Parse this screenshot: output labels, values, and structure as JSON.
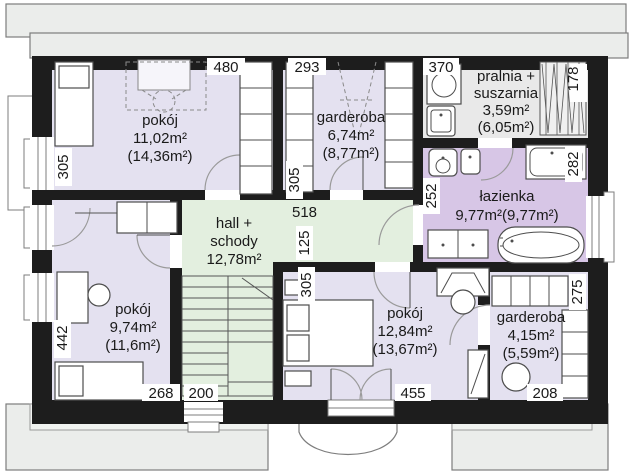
{
  "plan_title": "attic floor plan",
  "rooms": {
    "pokoj1": {
      "name": "pokój",
      "area": "11,02m²",
      "area_total": "(14,36m²)"
    },
    "garderoba1": {
      "name": "garderoba",
      "area": "6,74m²",
      "area_total": "(8,77m²)"
    },
    "pralnia": {
      "name_line1": "pralnia +",
      "name_line2": "suszarnia",
      "area": "3,59m²",
      "area_total": "(6,05m²)"
    },
    "lazienka": {
      "name": "łazienka",
      "area": "9,77m²(9,77m²)"
    },
    "hall": {
      "name_line1": "hall +",
      "name_line2": "schody",
      "area": "12,78m²"
    },
    "pokoj2": {
      "name": "pokój",
      "area": "9,74m²",
      "area_total": "(11,6m²)"
    },
    "pokoj3": {
      "name": "pokój",
      "area": "12,84m²",
      "area_total": "(13,67m²)"
    },
    "garderoba2": {
      "name": "garderoba",
      "area": "4,15m²",
      "area_total": "(5,59m²)"
    }
  },
  "dims": {
    "pokoj1_top": "480",
    "garderoba1_top": "293",
    "pralnia_top": "370",
    "rack_side": "178",
    "pokoj1_side": "305",
    "garderoba1_side": "305",
    "hall_top": "518",
    "hall_side": "125",
    "pokoj3_side": "305",
    "lazienka_side": "252",
    "shower_side": "282",
    "pokoj2_side": "442",
    "pokoj2_bottom": "268",
    "hall_bottom": "200",
    "pokoj3_bottom": "455",
    "garderoba2_side": "275",
    "garderoba2_bottom": "208"
  },
  "colors": {
    "bedroom": "#e4e1f0",
    "hall": "#e3efdf",
    "bathroom": "#d7c6e6",
    "utility": "#e9e9e9",
    "wall": "#1d1d1d",
    "roof": "#ebedeb"
  }
}
